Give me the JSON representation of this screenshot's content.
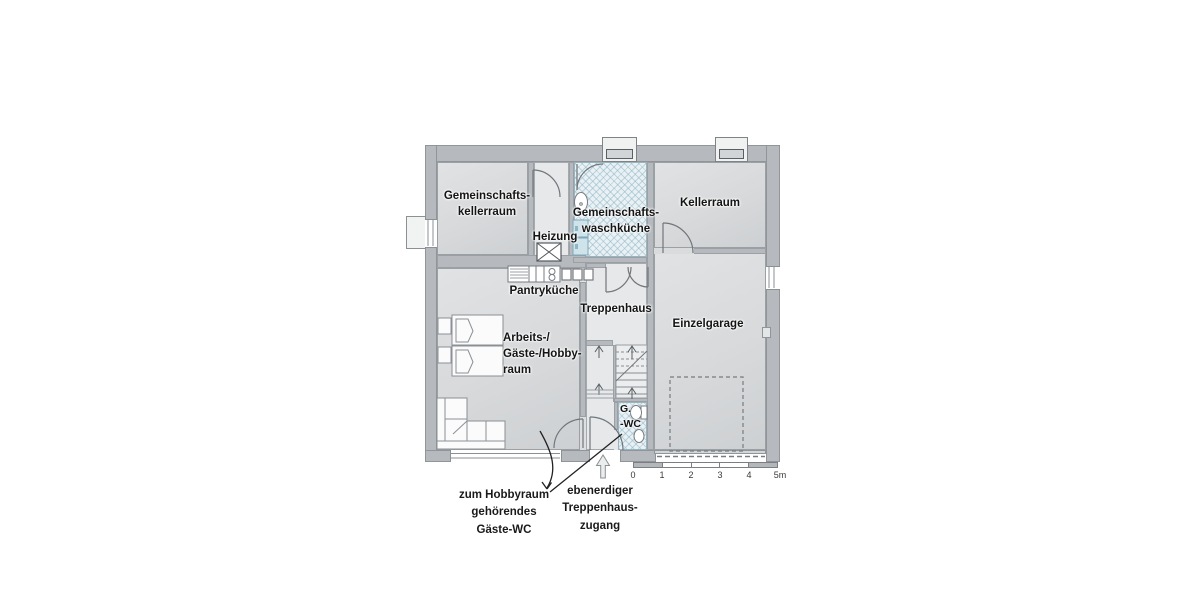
{
  "rooms": {
    "gemeinschaftskellerraum": {
      "label": "Gemeinschafts-\nkellerraum"
    },
    "heizung": {
      "label": "Heizung"
    },
    "waschkueche": {
      "label": "Gemeinschafts-\nwaschküche"
    },
    "kellerraum": {
      "label": "Kellerraum"
    },
    "pantrykueche": {
      "label": "Pantryküche"
    },
    "treppenhaus": {
      "label": "Treppenhaus"
    },
    "einzelgarage": {
      "label": "Einzelgarage"
    },
    "hobbyraum": {
      "label": "Arbeits-/\nGäste-/Hobby-\nraum"
    },
    "gaeste_wc": {
      "label": "G.\n-WC"
    }
  },
  "annotations": {
    "wc_note": "zum Hobbyraum\ngehörendes\nGäste-WC",
    "entry_note": "ebenerdiger\nTreppenhaus-\nzugang"
  },
  "scale_bar": {
    "unit": "m",
    "ticks": [
      "0",
      "1",
      "2",
      "3",
      "4",
      "5m"
    ]
  },
  "colors": {
    "wall": "#b6babe",
    "room_fill": "#d9dbdd",
    "corridor_fill": "#e3e5e7",
    "wet_room_fill": "#e9f1f4",
    "wet_hatch": "#8cb4c3",
    "appliance_fill": "#cfe3ea",
    "outline": "#8a9094",
    "text": "#141414"
  }
}
